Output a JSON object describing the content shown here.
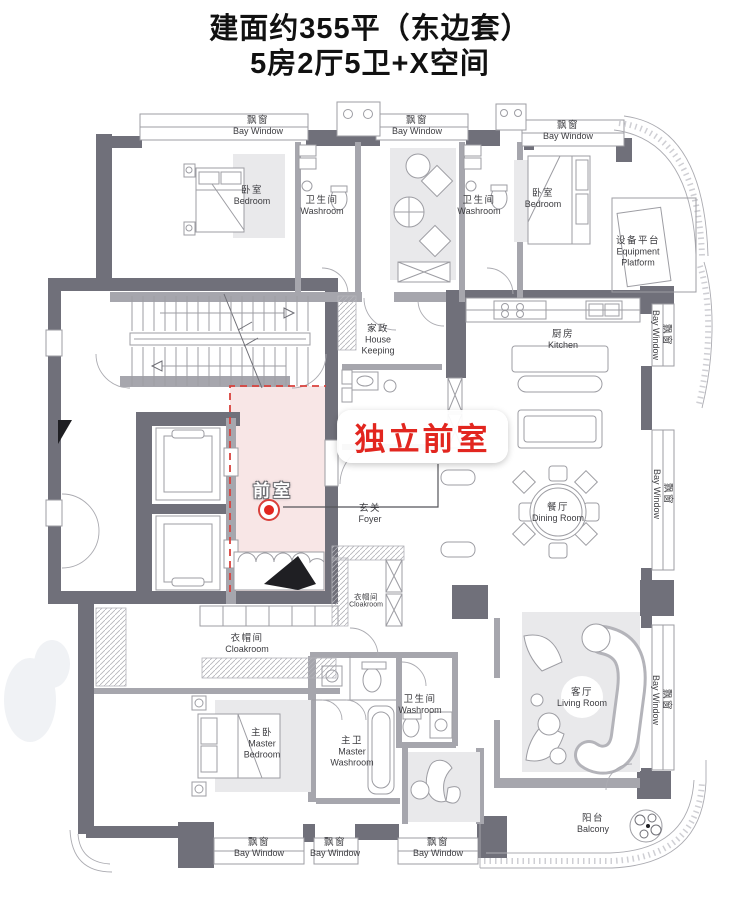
{
  "title": {
    "line1": "建面约355平（东边套）",
    "line2": "5房2厅5卫+X空间"
  },
  "highlight": {
    "callout": "独立前室",
    "room_label": "前室"
  },
  "rooms": {
    "bay_window": {
      "zh": "飘窗",
      "en": "Bay Window"
    },
    "bedroom": {
      "zh": "卧室",
      "en": "Bedroom"
    },
    "washroom": {
      "zh": "卫生间",
      "en": "Washroom"
    },
    "equipment_platform": {
      "zh": "设备平台",
      "en1": "Equipment",
      "en2": "Platform"
    },
    "house_keeping": {
      "zh": "家政",
      "en1": "House",
      "en2": "Keeping"
    },
    "kitchen": {
      "zh": "厨房",
      "en": "Kitchen"
    },
    "dining_room": {
      "zh": "餐厅",
      "en": "Dining Room"
    },
    "foyer": {
      "zh": "玄关",
      "en": "Foyer"
    },
    "living_room": {
      "zh": "客厅",
      "en": "Living Room"
    },
    "cloakroom": {
      "zh": "衣帽间",
      "en": "Cloakroom"
    },
    "master_bedroom": {
      "zh": "主卧",
      "en1": "Master",
      "en2": "Bedroom"
    },
    "master_washroom": {
      "zh": "主卫",
      "en1": "Master",
      "en2": "Washroom"
    },
    "balcony": {
      "zh": "阳台",
      "en": "Balcony"
    }
  },
  "colors": {
    "wall_dark": "#70707a",
    "pink_fill": "#f7e3e3",
    "dashed_red": "#d9413c",
    "accent_red": "#e2261f",
    "rug_gray": "#e9e9eb",
    "line_gray": "#9d9da3",
    "label_gray": "#3c3c40",
    "title_black": "#111111"
  }
}
